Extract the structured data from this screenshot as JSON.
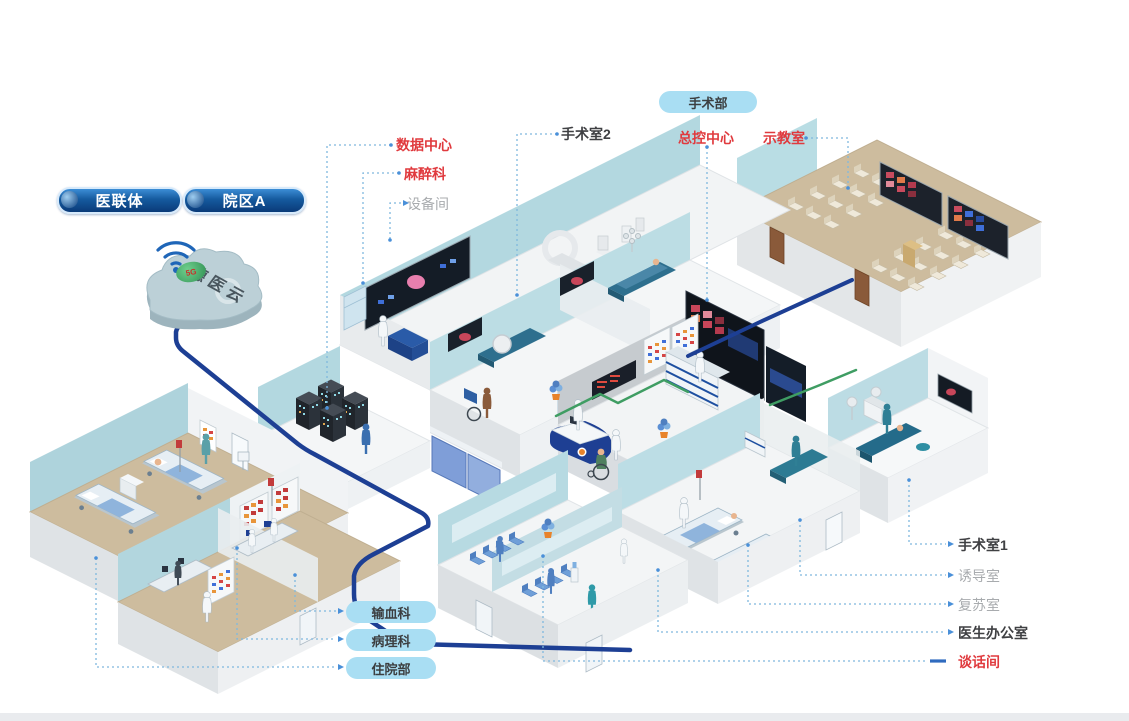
{
  "colors": {
    "cable_navy": "#1d3f94",
    "cable_green": "#3f9d63",
    "label_red": "#e03a3e",
    "label_dark": "#3f4043",
    "label_gray": "#a8abae",
    "leader_blue": "#7fb8de",
    "pill_light_bg": "#a9def3",
    "pill_dark_top": "#3c8ed6",
    "pill_dark_bottom": "#0a3a78",
    "wall_blue": "#b3d8e0",
    "floor_tan": "#cdbc9e",
    "screen_dark": "#141c26",
    "cloud_fill": "#bcd0d7"
  },
  "cloud": {
    "name": "德医云",
    "badge": "5G"
  },
  "pills": {
    "consortium": "医联体",
    "campus": "院区A",
    "department": "手术部"
  },
  "callouts": {
    "data_center": {
      "text": "数据中心",
      "style": "red"
    },
    "anesthesiology": {
      "text": "麻醉科",
      "style": "red"
    },
    "equipment_room": {
      "text": "设备间",
      "style": "gray"
    },
    "operating_room_2": {
      "text": "手术室2",
      "style": "dark"
    },
    "master_control": {
      "text": "总控中心",
      "style": "red"
    },
    "demo_classroom": {
      "text": "示教室",
      "style": "red"
    },
    "operating_room_1": {
      "text": "手术室1",
      "style": "dark"
    },
    "induction_room": {
      "text": "诱导室",
      "style": "gray"
    },
    "recovery_room": {
      "text": "复苏室",
      "style": "gray"
    },
    "doctor_office": {
      "text": "医生办公室",
      "style": "dark"
    },
    "talk_room": {
      "text": "谈话间",
      "style": "red"
    },
    "blood_transfusion": {
      "text": "输血科",
      "style": "pill"
    },
    "pathology": {
      "text": "病理科",
      "style": "pill"
    },
    "inpatient": {
      "text": "住院部",
      "style": "pill"
    }
  },
  "scene": {
    "or_marks": [
      "OR2",
      "OR3"
    ]
  }
}
